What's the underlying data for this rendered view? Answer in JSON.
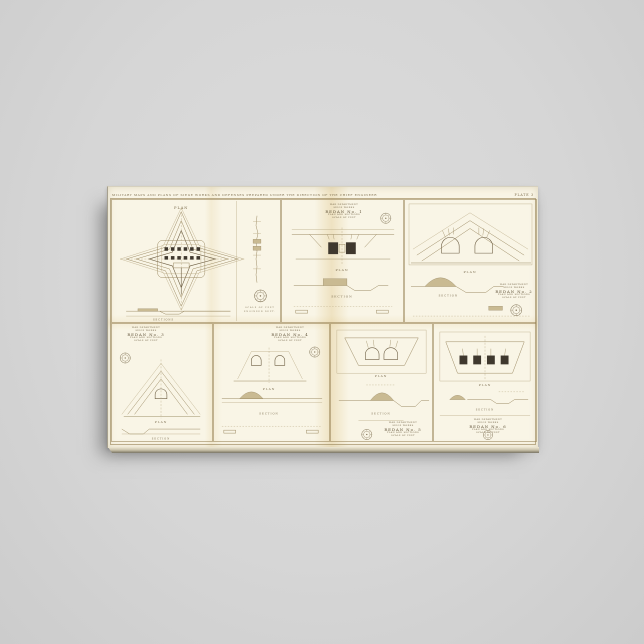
{
  "scene": {
    "product": "stretched canvas print of an antique fortification atlas sheet",
    "background_color": "#d6d6d6",
    "paper_color": "#f9f5e6",
    "ink_color": "#8d7c58",
    "dark_ink_color": "#3f382e",
    "aged_fold_color": "#e7d9ae",
    "rule_color": "#b5a577"
  },
  "sheet": {
    "top_caption": "MILITARY MAPS AND PLANS OF SIEGE WORKS AND DEFENSES  PREPARED UNDER THE DIRECTION OF THE CHIEF ENGINEER",
    "plate_label": "PLATE 3"
  },
  "panels": [
    {
      "name": "star-fort",
      "plan_label": "PLAN",
      "section_label": "SECTIONS",
      "note_lines": [
        "SCALE OF FEET",
        "ENGINEER DEPT."
      ],
      "elevation_label": "PROFILE"
    },
    {
      "name": "redan-1",
      "title_lines": [
        "WAR DEPARTMENT",
        "SIEGE WORKS",
        "REDAN No. 1",
        "PLAN AND SECTIONS",
        "SCALE OF FEET"
      ],
      "plan_label": "PLAN",
      "section_label": "SECTION"
    },
    {
      "name": "redan-2",
      "title_lines": [
        "WAR DEPARTMENT",
        "SIEGE WORKS",
        "REDAN No. 2",
        "PLAN AND SECTIONS",
        "SCALE OF FEET"
      ],
      "plan_label": "PLAN",
      "section_label": "SECTION"
    },
    {
      "name": "redan-3",
      "title_lines": [
        "WAR DEPARTMENT",
        "SIEGE WORKS",
        "REDAN No. 3",
        "PLAN AND SECTIONS",
        "SCALE OF FEET"
      ],
      "plan_label": "PLAN",
      "section_label": "SECTION"
    },
    {
      "name": "redan-4",
      "title_lines": [
        "WAR DEPARTMENT",
        "SIEGE WORKS",
        "REDAN No. 4",
        "PLAN AND SECTIONS",
        "SCALE OF FEET"
      ],
      "plan_label": "PLAN",
      "section_label": "SECTION"
    },
    {
      "name": "redan-5",
      "title_lines": [
        "WAR DEPARTMENT",
        "SIEGE WORKS",
        "REDAN No. 5",
        "PLAN AND SECTIONS",
        "SCALE OF FEET"
      ],
      "plan_label": "PLAN",
      "section_label": "SECTION"
    },
    {
      "name": "redan-6",
      "title_lines": [
        "WAR DEPARTMENT",
        "SIEGE WORKS",
        "REDAN No. 6",
        "PLAN AND SECTIONS",
        "SCALE OF FEET"
      ],
      "plan_label": "PLAN",
      "section_label": "SECTION"
    }
  ]
}
